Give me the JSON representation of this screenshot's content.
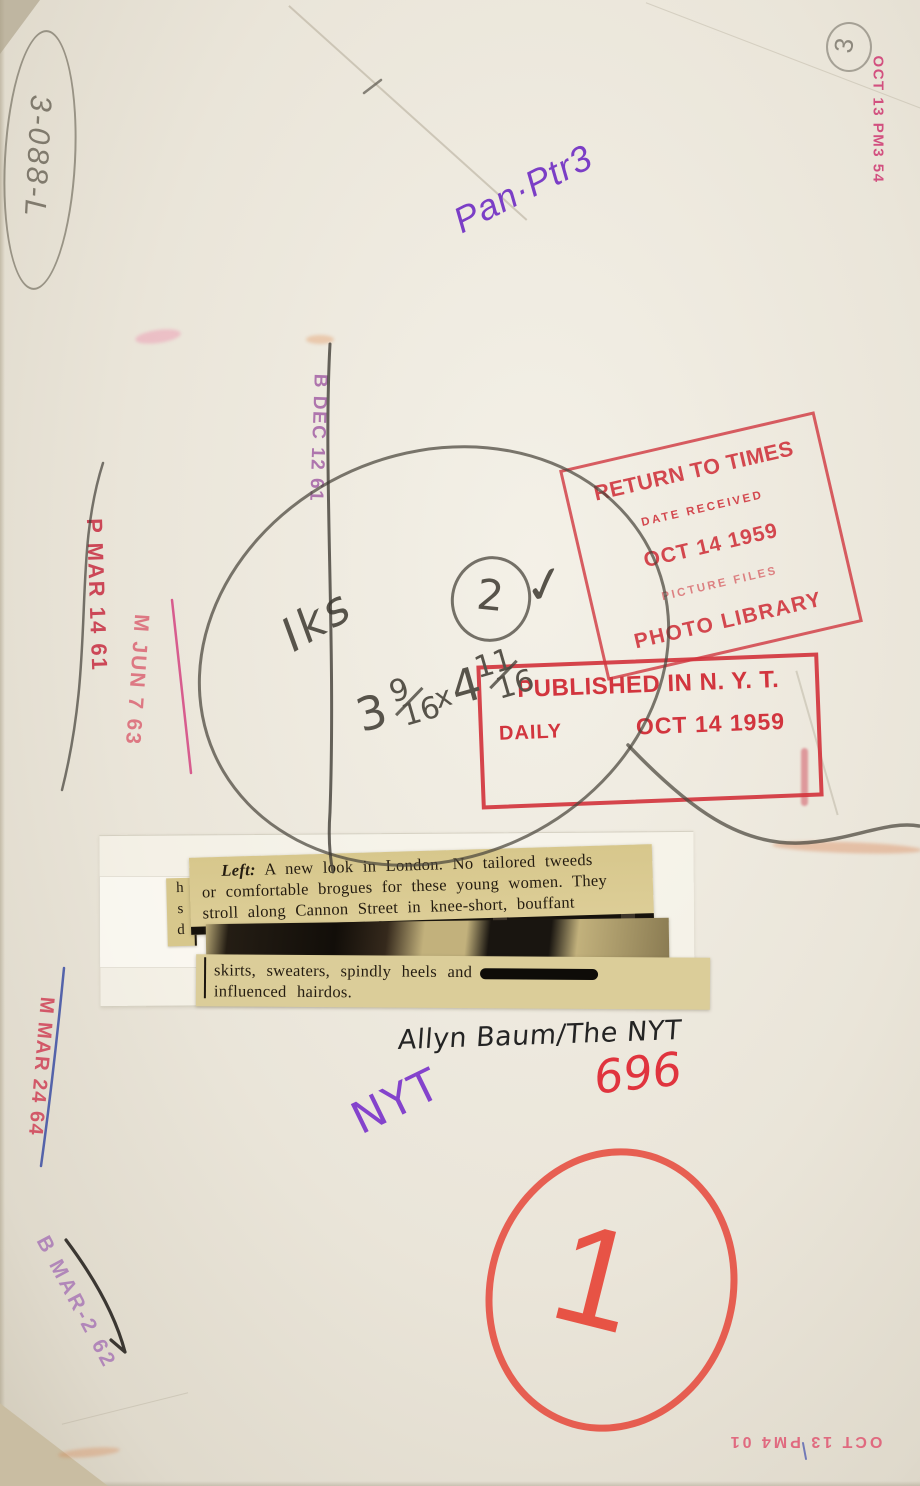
{
  "annotations": {
    "archive_number": "3-088-L",
    "edition_circle_top": "3",
    "routing_note": "Pan·Ptr3",
    "print_note": "Iks",
    "print_note_circled": "2",
    "print_note_check": "✓",
    "size_note": {
      "w": "3",
      "w_num": "9",
      "w_den": "16",
      "times": "x",
      "h": "4",
      "h_num": "11",
      "h_den": "16"
    },
    "credit": "Allyn Baum/The NYT",
    "negative_number": "696",
    "nyt_initials": "NYT",
    "circled_number": "1"
  },
  "stamps": {
    "timestamp_top_right": "OCT 13 PM3 54",
    "timestamp_bottom": "OCT 13 PM4 01",
    "return_to_times": {
      "title": "RETURN TO TIMES",
      "subtitle": "DATE RECEIVED",
      "date": "OCT 14 1959",
      "files_line": "PICTURE FILES",
      "library_line": "PHOTO LIBRARY"
    },
    "published": {
      "title": "PUBLISHED IN N. Y. T.",
      "edition": "DAILY",
      "date": "OCT 14 1959"
    },
    "date_stamps": [
      {
        "text": "B DEC 12 61"
      },
      {
        "text": "P MAR 14 61"
      },
      {
        "text": "M JUN 7 63"
      },
      {
        "text": "M MAR 24 64"
      },
      {
        "text": "B MAR-2 62"
      }
    ]
  },
  "clipping": {
    "margin_letters": [
      "h",
      "s",
      "d"
    ],
    "caption_lead": "Left:",
    "line1": " A new look in London. No tailored tweeds",
    "line2": "or comfortable brogues for these young women. They",
    "line3": "stroll along Cannon Street in knee-short, bouffant",
    "line4": "skirts, sweaters, spindly heels and",
    "line5": "influenced hairdos."
  },
  "colors": {
    "stamp_red": "#d23f47",
    "stamp_magenta": "#cf3f76",
    "stamp_purple": "#a260a4",
    "ink_purple": "#7b3ec6",
    "crayon_red": "#e3362b",
    "pencil_gray": "#57534a",
    "newsprint": "#d7c78c"
  }
}
